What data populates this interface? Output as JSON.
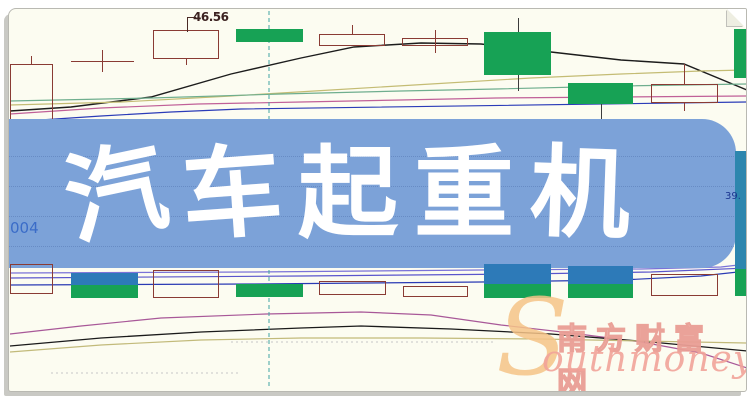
{
  "banner": {
    "title": "汽车起重机",
    "bg_color": "#7ca2d8",
    "text_color": "#ffffff"
  },
  "labels": {
    "price_annotation": "46.56",
    "left_code_fragment": "004",
    "right_price_fragment": "39."
  },
  "watermark": {
    "cn_text": "南方财富网",
    "en_initial": "S",
    "en_rest": "outhmoney.com",
    "initial_color": "#f6c488",
    "en_color": "#f2a49a",
    "cn_outline_color": "#ea9e95"
  },
  "colors": {
    "page_background": "#fcfcf1",
    "banner_blue": "#7ca2d8",
    "bull_green": "#17a255",
    "bear_outline": "#8a3b34",
    "volume_cap_blue": "#2d7ab8",
    "cursor_teal": "#3fa3a3"
  },
  "chart_data": {
    "type": "candlestick",
    "title": "",
    "axes_visible": false,
    "visible_price_labels": [
      "46.56",
      "39."
    ],
    "cursor": {
      "x": 268,
      "y1": 10,
      "y2": 388,
      "color": "#3fa3a3"
    },
    "price_pane": {
      "candles": [
        {
          "kind": "hollow",
          "x": 9,
          "y": 63,
          "w": 43,
          "h": 62,
          "wicks": [
            {
              "x": 30,
              "y1": 55,
              "y2": 63
            }
          ]
        },
        {
          "kind": "doji",
          "x": 70,
          "y": 60,
          "w": 63,
          "h": 1,
          "wicks": [
            {
              "x": 101,
              "y1": 49,
              "y2": 71
            }
          ]
        },
        {
          "kind": "hollow",
          "x": 152,
          "y": 29,
          "w": 66,
          "h": 29,
          "wicks": [
            {
              "x": 185,
              "y1": 58,
              "y2": 64
            }
          ],
          "annotation": "46.56"
        },
        {
          "kind": "green",
          "x": 235,
          "y": 28,
          "w": 67,
          "h": 13,
          "wicks": []
        },
        {
          "kind": "hollow",
          "x": 318,
          "y": 33,
          "w": 66,
          "h": 12,
          "wicks": [
            {
              "x": 351,
              "y1": 24,
              "y2": 33
            }
          ]
        },
        {
          "kind": "hollow",
          "x": 401,
          "y": 37,
          "w": 66,
          "h": 8,
          "wicks": [
            {
              "x": 434,
              "y1": 29,
              "y2": 52
            }
          ]
        },
        {
          "kind": "green",
          "x": 483,
          "y": 31,
          "w": 67,
          "h": 43,
          "wicks": [
            {
              "x": 517,
              "y1": 17,
              "y2": 31
            },
            {
              "x": 517,
              "y1": 74,
              "y2": 90
            }
          ]
        },
        {
          "kind": "green",
          "x": 567,
          "y": 82,
          "w": 65,
          "h": 21,
          "wicks": [
            {
              "x": 600,
              "y1": 103,
              "y2": 122
            }
          ]
        },
        {
          "kind": "hollow",
          "x": 650,
          "y": 83,
          "w": 67,
          "h": 19,
          "wicks": [
            {
              "x": 683,
              "y1": 63,
              "y2": 83
            },
            {
              "x": 683,
              "y1": 102,
              "y2": 110
            }
          ]
        },
        {
          "kind": "green",
          "x": 733,
          "y": 28,
          "w": 15,
          "h": 49,
          "wicks": []
        }
      ],
      "lines": [
        {
          "name": "ma-black",
          "color": "#1c1c1c",
          "width": 1.4,
          "points": [
            [
              9,
              110
            ],
            [
              70,
              106
            ],
            [
              150,
              96
            ],
            [
              230,
              73
            ],
            [
              300,
              57
            ],
            [
              353,
              46
            ],
            [
              420,
              42
            ],
            [
              480,
              43
            ],
            [
              550,
              51
            ],
            [
              620,
              59
            ],
            [
              683,
              63
            ],
            [
              746,
              89
            ]
          ]
        },
        {
          "name": "ma-khaki",
          "color": "#c4bc74",
          "width": 1.2,
          "points": [
            [
              9,
              104
            ],
            [
              120,
              101
            ],
            [
              230,
              95
            ],
            [
              330,
              89
            ],
            [
              430,
              83
            ],
            [
              530,
              77
            ],
            [
              620,
              73
            ],
            [
              700,
              70
            ],
            [
              746,
              69
            ]
          ]
        },
        {
          "name": "ma-green",
          "color": "#6fae8e",
          "width": 1.2,
          "points": [
            [
              9,
              100
            ],
            [
              150,
              97
            ],
            [
              280,
              93
            ],
            [
              400,
              90
            ],
            [
              495,
              88
            ],
            [
              620,
              85
            ],
            [
              746,
              83
            ]
          ]
        },
        {
          "name": "ma-pink",
          "color": "#c06098",
          "width": 1.2,
          "points": [
            [
              9,
              113
            ],
            [
              100,
              107
            ],
            [
              197,
              103
            ],
            [
              300,
              101
            ],
            [
              400,
              99
            ],
            [
              495,
              97
            ],
            [
              620,
              96
            ],
            [
              746,
              95
            ]
          ]
        },
        {
          "name": "ma-blue",
          "color": "#2b3cb8",
          "width": 1.2,
          "points": [
            [
              9,
              121
            ],
            [
              100,
              115
            ],
            [
              170,
              111
            ],
            [
              240,
              108
            ],
            [
              746,
              101
            ]
          ]
        }
      ]
    },
    "volume_pane": {
      "bars": [
        {
          "kind": "hollow",
          "x": 9,
          "y": 263,
          "w": 43,
          "h": 30
        },
        {
          "kind": "greenblue",
          "x": 70,
          "y": 272,
          "w": 67,
          "h": 25,
          "split": 12
        },
        {
          "kind": "hollow",
          "x": 152,
          "y": 269,
          "w": 66,
          "h": 28
        },
        {
          "kind": "green",
          "x": 235,
          "y": 283,
          "w": 67,
          "h": 13
        },
        {
          "kind": "hollow",
          "x": 318,
          "y": 280,
          "w": 67,
          "h": 14
        },
        {
          "kind": "hollow",
          "x": 402,
          "y": 285,
          "w": 65,
          "h": 11
        },
        {
          "kind": "greenblue",
          "x": 483,
          "y": 263,
          "w": 67,
          "h": 34,
          "split": 20
        },
        {
          "kind": "greenblue",
          "x": 567,
          "y": 265,
          "w": 65,
          "h": 32,
          "split": 18
        },
        {
          "kind": "hollow",
          "x": 650,
          "y": 273,
          "w": 67,
          "h": 22
        },
        {
          "kind": "tealstrip",
          "x": 734,
          "y": 150,
          "w": 14,
          "h": 145,
          "split": 118
        }
      ],
      "lines": [
        {
          "name": "vol-ma-purple",
          "color": "#7a72d8",
          "width": 1.2,
          "points": [
            [
              9,
              272
            ],
            [
              250,
              271
            ],
            [
              480,
              269
            ],
            [
              640,
              268
            ],
            [
              720,
              266
            ],
            [
              746,
              263
            ]
          ]
        },
        {
          "name": "vol-ma-violet",
          "color": "#5a55cc",
          "width": 1.2,
          "points": [
            [
              9,
              277
            ],
            [
              300,
              275
            ],
            [
              520,
              273
            ],
            [
              650,
              271
            ],
            [
              746,
              267
            ]
          ]
        },
        {
          "name": "vol-ma-blue",
          "color": "#2a3ab4",
          "width": 1.2,
          "points": [
            [
              9,
              284
            ],
            [
              250,
              283
            ],
            [
              480,
              281
            ],
            [
              620,
              279
            ],
            [
              700,
              275
            ],
            [
              746,
              270
            ]
          ]
        }
      ]
    },
    "indicator_pane": {
      "lines": [
        {
          "name": "ind-magenta",
          "color": "#a85898",
          "width": 1.2,
          "points": [
            [
              9,
              333
            ],
            [
              80,
              325
            ],
            [
              160,
              317
            ],
            [
              265,
              313
            ],
            [
              360,
              311
            ],
            [
              430,
              314
            ],
            [
              500,
              324
            ],
            [
              570,
              332
            ],
            [
              640,
              341
            ],
            [
              700,
              352
            ],
            [
              746,
              367
            ]
          ]
        },
        {
          "name": "ind-black",
          "color": "#1a1a1a",
          "width": 1.3,
          "points": [
            [
              9,
              345
            ],
            [
              100,
              337
            ],
            [
              200,
              331
            ],
            [
              300,
              327
            ],
            [
              360,
              325
            ],
            [
              450,
              328
            ],
            [
              550,
              333
            ],
            [
              650,
              341
            ],
            [
              746,
              350
            ]
          ]
        },
        {
          "name": "ind-khaki",
          "color": "#c2ba7a",
          "width": 1.2,
          "points": [
            [
              9,
              351
            ],
            [
              100,
              344
            ],
            [
              200,
              339
            ],
            [
              300,
              337
            ],
            [
              420,
              337
            ],
            [
              540,
              338
            ],
            [
              640,
              340
            ],
            [
              746,
              342
            ]
          ]
        }
      ],
      "dotted_gridlines": [
        {
          "x1": 50,
          "y": 372,
          "x2": 240
        },
        {
          "x1": 230,
          "y": 341,
          "x2": 495
        }
      ]
    }
  }
}
